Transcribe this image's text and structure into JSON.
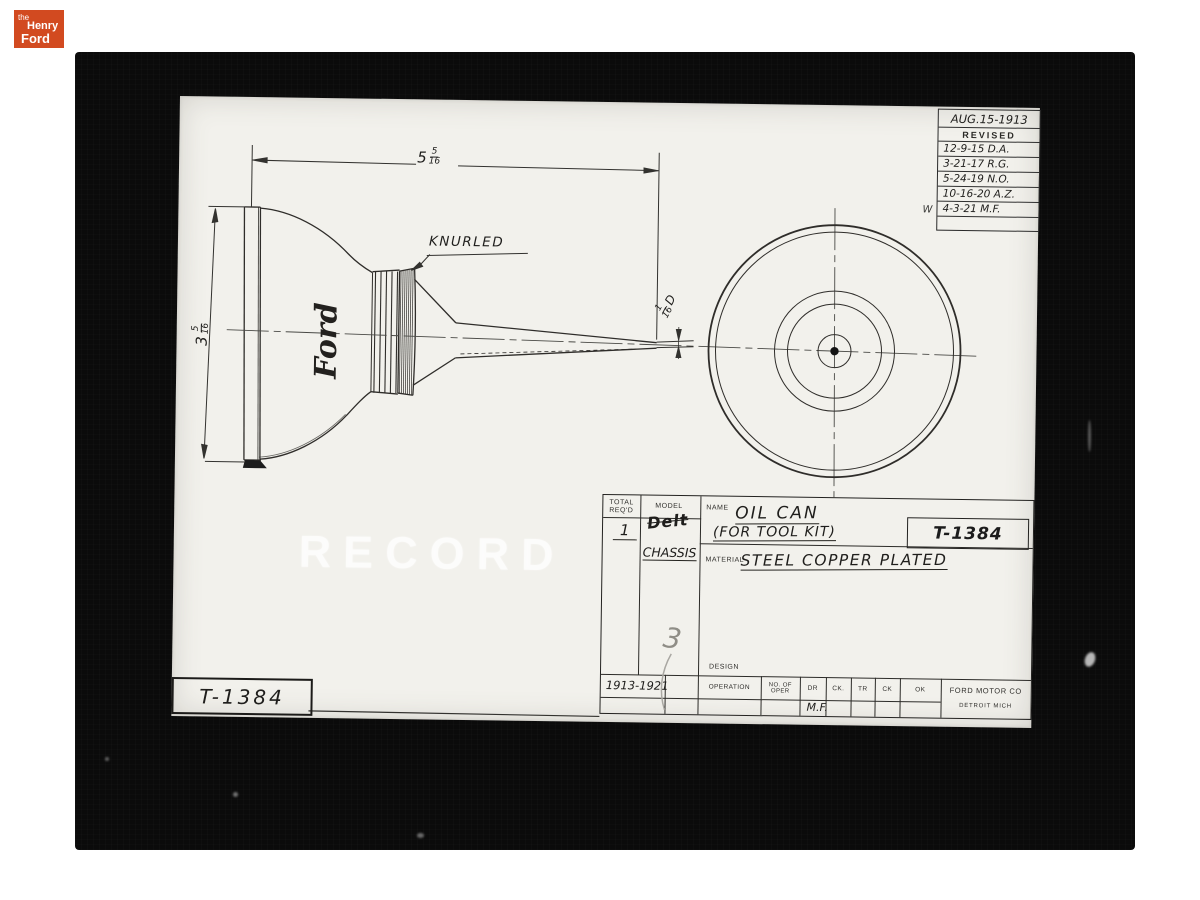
{
  "branding": {
    "the": "the",
    "henry": "Henry",
    "ford": "Ford",
    "bg_color": "#d24a20"
  },
  "revision_table": {
    "date": "AUG.15-1913",
    "title": "REVISED",
    "entries": [
      "12-9-15 D.A.",
      "3-21-17 R.G.",
      "5-24-19 N.O.",
      "10-16-20 A.Z.",
      "4-3-21 M.F."
    ],
    "margin_note": "W"
  },
  "drawing": {
    "knurled_label": "KNURLED",
    "ford_script": "Ford",
    "watermark": "RECORD",
    "stamp_number": "T-1384",
    "dim_width": {
      "whole": "5",
      "num": "5",
      "den": "16"
    },
    "dim_height": {
      "whole": "3",
      "num": "5",
      "den": "16"
    },
    "dim_tip": {
      "num": "1",
      "den": "16",
      "suffix": "D"
    }
  },
  "title_block": {
    "total_label_1": "TOTAL",
    "total_label_2": "REQ'D",
    "total_value": "1",
    "model_label": "MODEL",
    "model_crossed_out": "Delt",
    "model_value": "CHASSIS",
    "name_label": "NAME",
    "name_value": "OIL CAN",
    "name_value_2": "(FOR TOOL KIT)",
    "part_number": "T-1384",
    "material_label": "MATERIAL",
    "material_value": "STEEL COPPER PLATED",
    "years": "1913-1921",
    "pencil_note": "3",
    "design_label": "DESIGN",
    "op_headers": [
      "OPERATION",
      "NO. OF OPER",
      "DR",
      "CK.",
      "TR",
      "CK",
      "OK"
    ],
    "dr_value": "M.F.",
    "company_name": "FORD MOTOR CO",
    "company_city": "DETROIT MICH"
  }
}
